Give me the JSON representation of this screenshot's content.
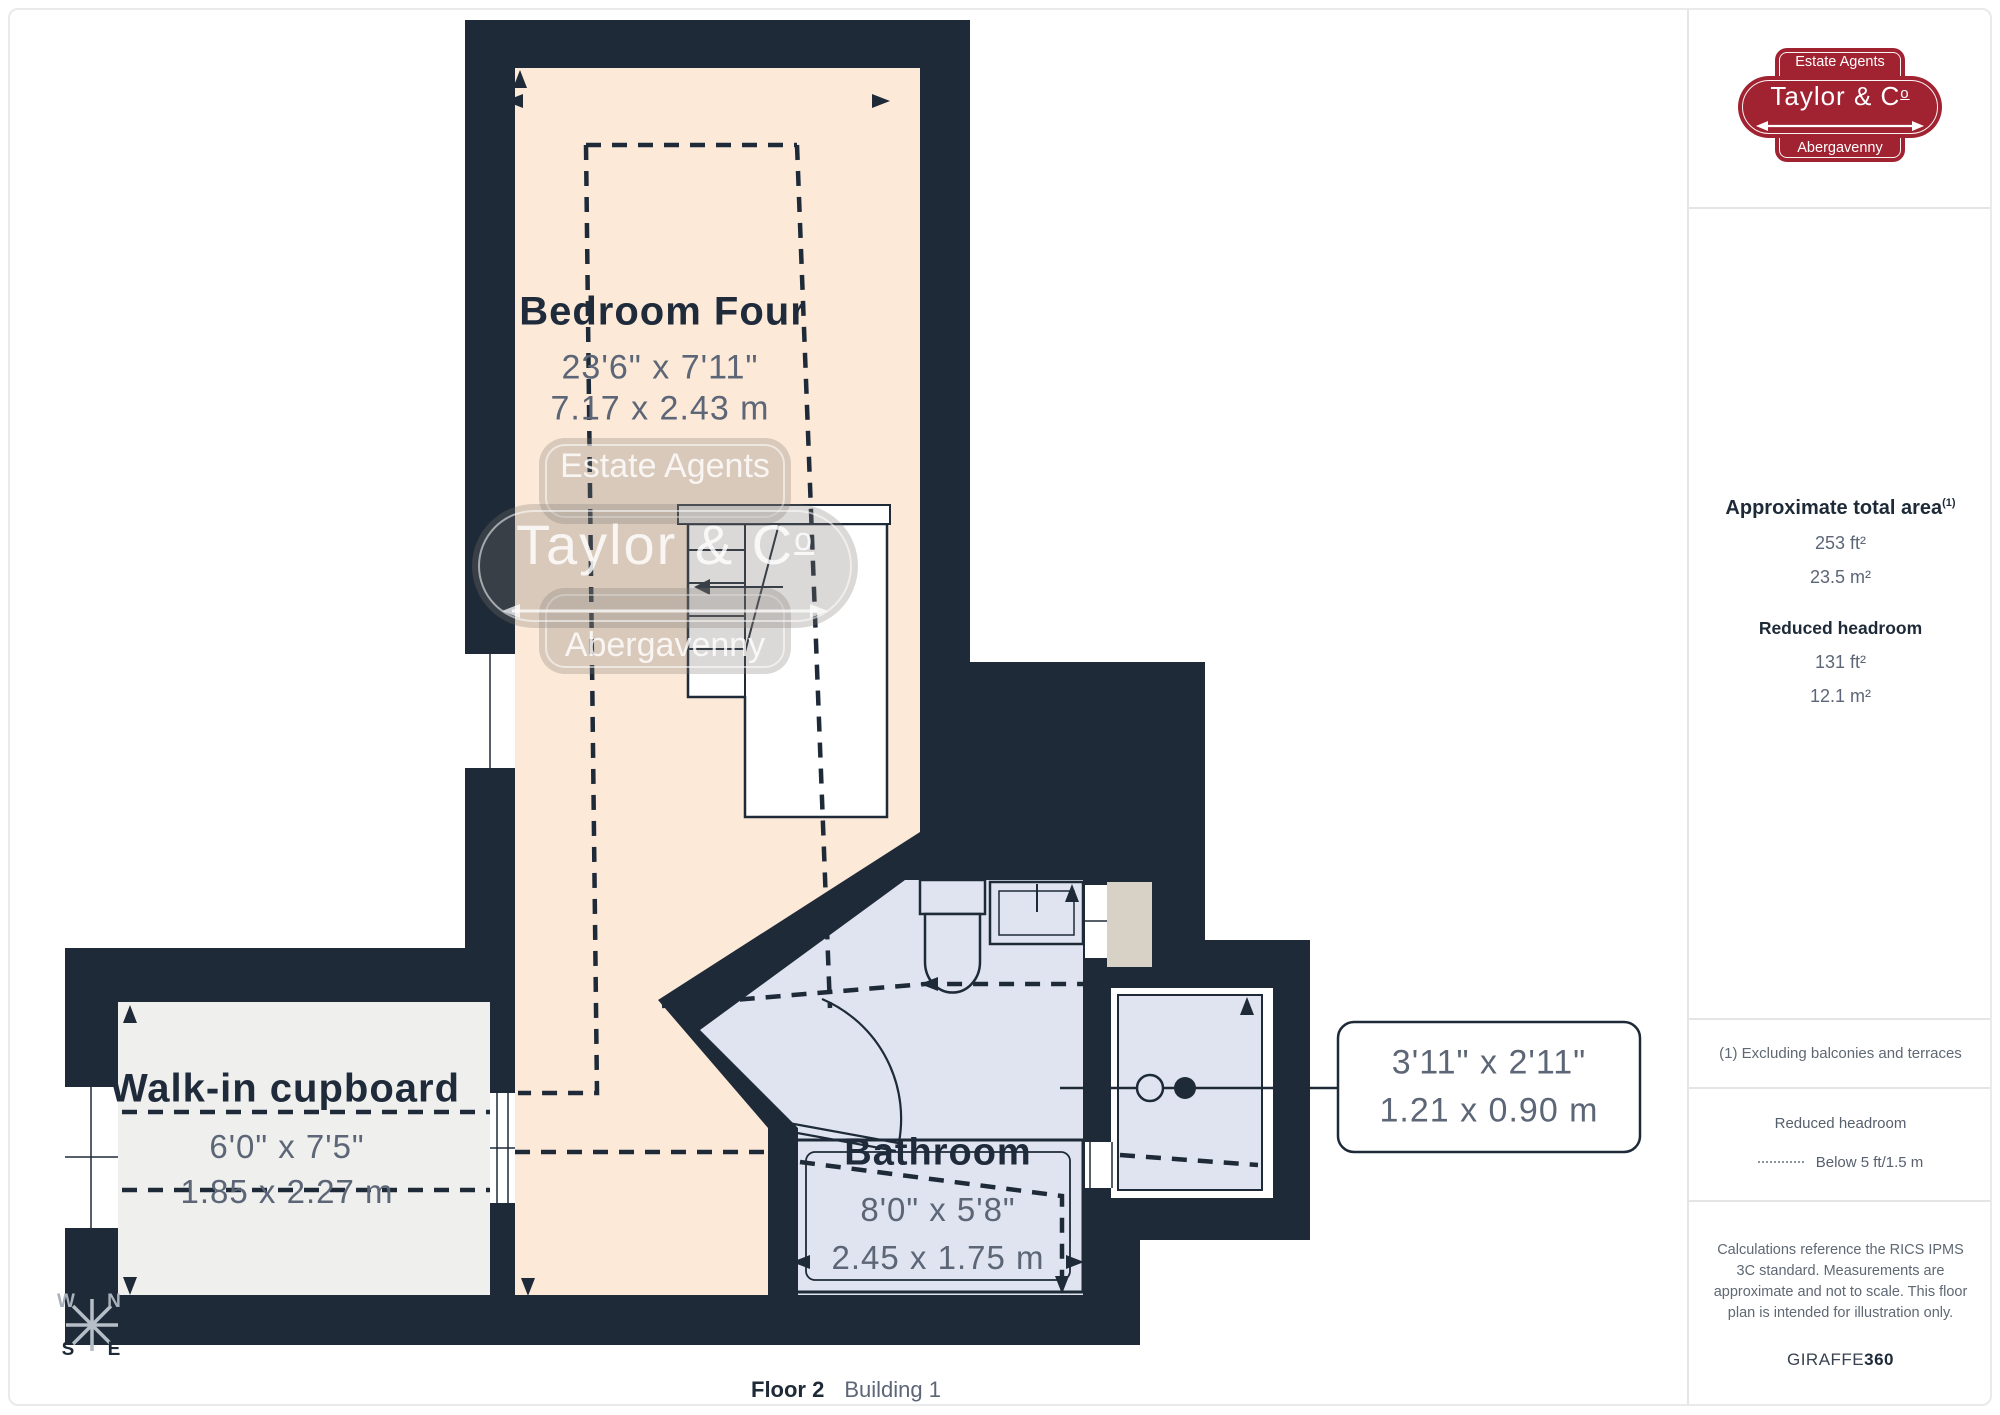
{
  "plan": {
    "rooms": {
      "bedroom": {
        "name": "Bedroom Four",
        "imperial": "23'6\" x 7'11\"",
        "metric": "7.17 x 2.43 m"
      },
      "cupboard": {
        "name": "Walk-in cupboard",
        "imperial": "6'0\" x 7'5\"",
        "metric": "1.85 x 2.27 m"
      },
      "bathroom": {
        "name": "Bathroom",
        "imperial": "8'0\" x 5'8\"",
        "metric": "2.45 x 1.75 m"
      }
    },
    "callout": {
      "imperial": "3'11\" x 2'11\"",
      "metric": "1.21 x 0.90 m"
    },
    "compass": {
      "w": "W",
      "n": "N",
      "s": "S",
      "e": "E"
    },
    "footer": {
      "floor": "Floor 2",
      "building": "Building 1"
    }
  },
  "logo": {
    "top": "Estate Agents",
    "name_main": "Taylor & C",
    "name_o": "o",
    "bottom": "Abergavenny"
  },
  "sidebar": {
    "area": {
      "title": "Approximate total area",
      "sup": "(1)",
      "imperial": "253 ft²",
      "metric": "23.5 m²"
    },
    "reduced": {
      "title": "Reduced headroom",
      "imperial": "131 ft²",
      "metric": "12.1 m²"
    },
    "note": "(1) Excluding balconies and terraces",
    "legend": {
      "title": "Reduced headroom",
      "value": "Below 5 ft/1.5 m"
    },
    "disclaimer": "Calculations reference the RICS IPMS 3C standard. Measurements are approximate and not to scale. This floor plan is intended for illustration only.",
    "brand": {
      "name": "GIRAFFE",
      "suffix": "360"
    }
  },
  "colors": {
    "wall": "#1e2a38",
    "bedroom_floor": "#fce9d8",
    "bath_floor": "#dfe4f0",
    "cupboard_floor": "#efefee",
    "beige": "#d8d1c5",
    "accent_red": "#a12231",
    "dim_text": "#5c6676"
  }
}
